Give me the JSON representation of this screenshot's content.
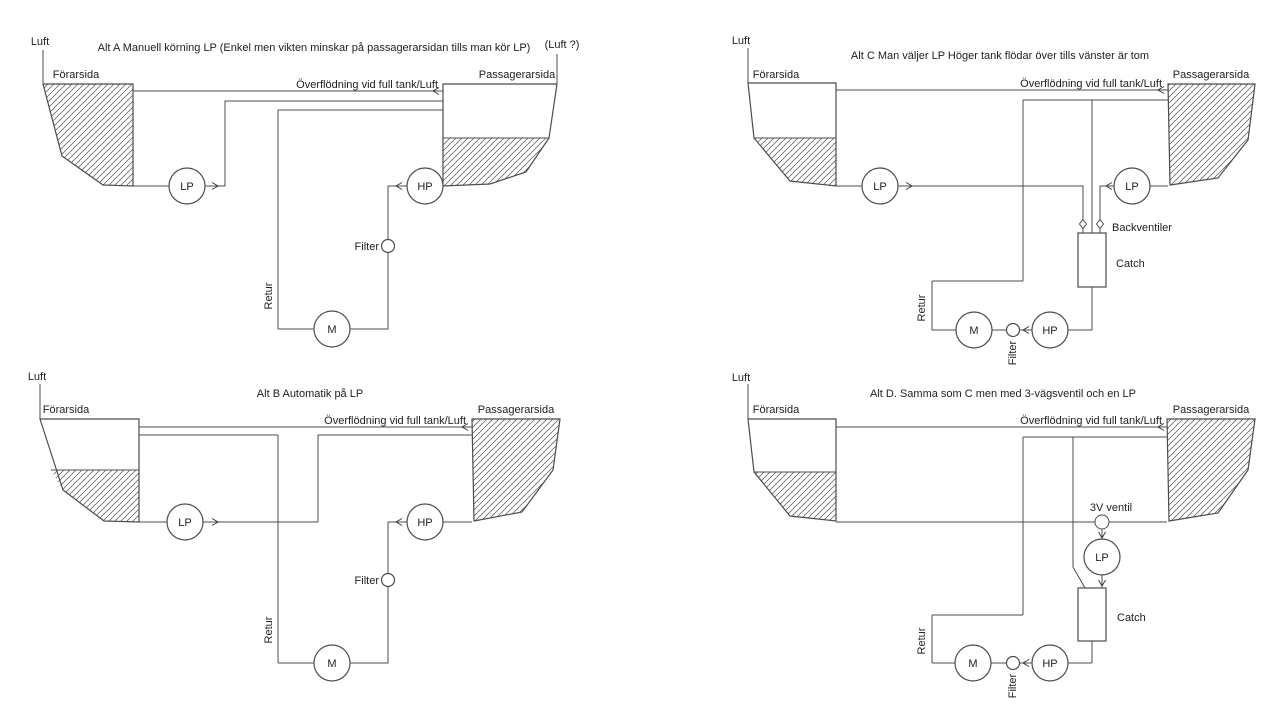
{
  "app": {
    "background_color": "#ffffff",
    "line_color": "#4c4c4c",
    "text_color": "#212121"
  },
  "diagrams": {
    "alt_a": {
      "title": "Alt A Manuell körning LP (Enkel men vikten minskar på passagerarsidan tills man kör LP)",
      "air_label": "Luft",
      "air_right_label": "(Luft ?)",
      "driver_side_label": "Förarsida",
      "passenger_side_label": "Passagerarsida",
      "overflow_label": "Överflödning vid full tank/Luft",
      "return_label": "Retur",
      "filter_label": "Filter",
      "lp_pump_label": "LP",
      "hp_pump_label": "HP",
      "motor_label": "M"
    },
    "alt_b": {
      "title": "Alt B Automatik på LP",
      "air_label": "Luft",
      "driver_side_label": "Förarsida",
      "passenger_side_label": "Passagerarsida",
      "overflow_label": "Överflödning vid full tank/Luft",
      "return_label": "Retur",
      "filter_label": "Filter",
      "lp_pump_label": "LP",
      "hp_pump_label": "HP",
      "motor_label": "M"
    },
    "alt_c": {
      "title": "Alt C Man väljer LP Höger tank flödar över tills vänster är tom",
      "air_label": "Luft",
      "driver_side_label": "Förarsida",
      "passenger_side_label": "Passagerarsida",
      "overflow_label": "Överflödning vid full tank/Luft",
      "check_valves_label": "Backventiler",
      "catch_tank_label": "Catch",
      "return_label": "Retur",
      "filter_label": "Filter",
      "lp_pump_left_label": "LP",
      "lp_pump_right_label": "LP",
      "hp_pump_label": "HP",
      "motor_label": "M"
    },
    "alt_d": {
      "title": "Alt  D. Samma som C men med 3-vägsventil och en LP",
      "air_label": "Luft",
      "driver_side_label": "Förarsida",
      "passenger_side_label": "Passagerarsida",
      "overflow_label": "Överflödning vid full tank/Luft",
      "three_way_valve_label": "3V ventil",
      "catch_tank_label": "Catch",
      "return_label": "Retur",
      "filter_label": "Filter",
      "lp_pump_label": "LP",
      "hp_pump_label": "HP",
      "motor_label": "M"
    }
  }
}
